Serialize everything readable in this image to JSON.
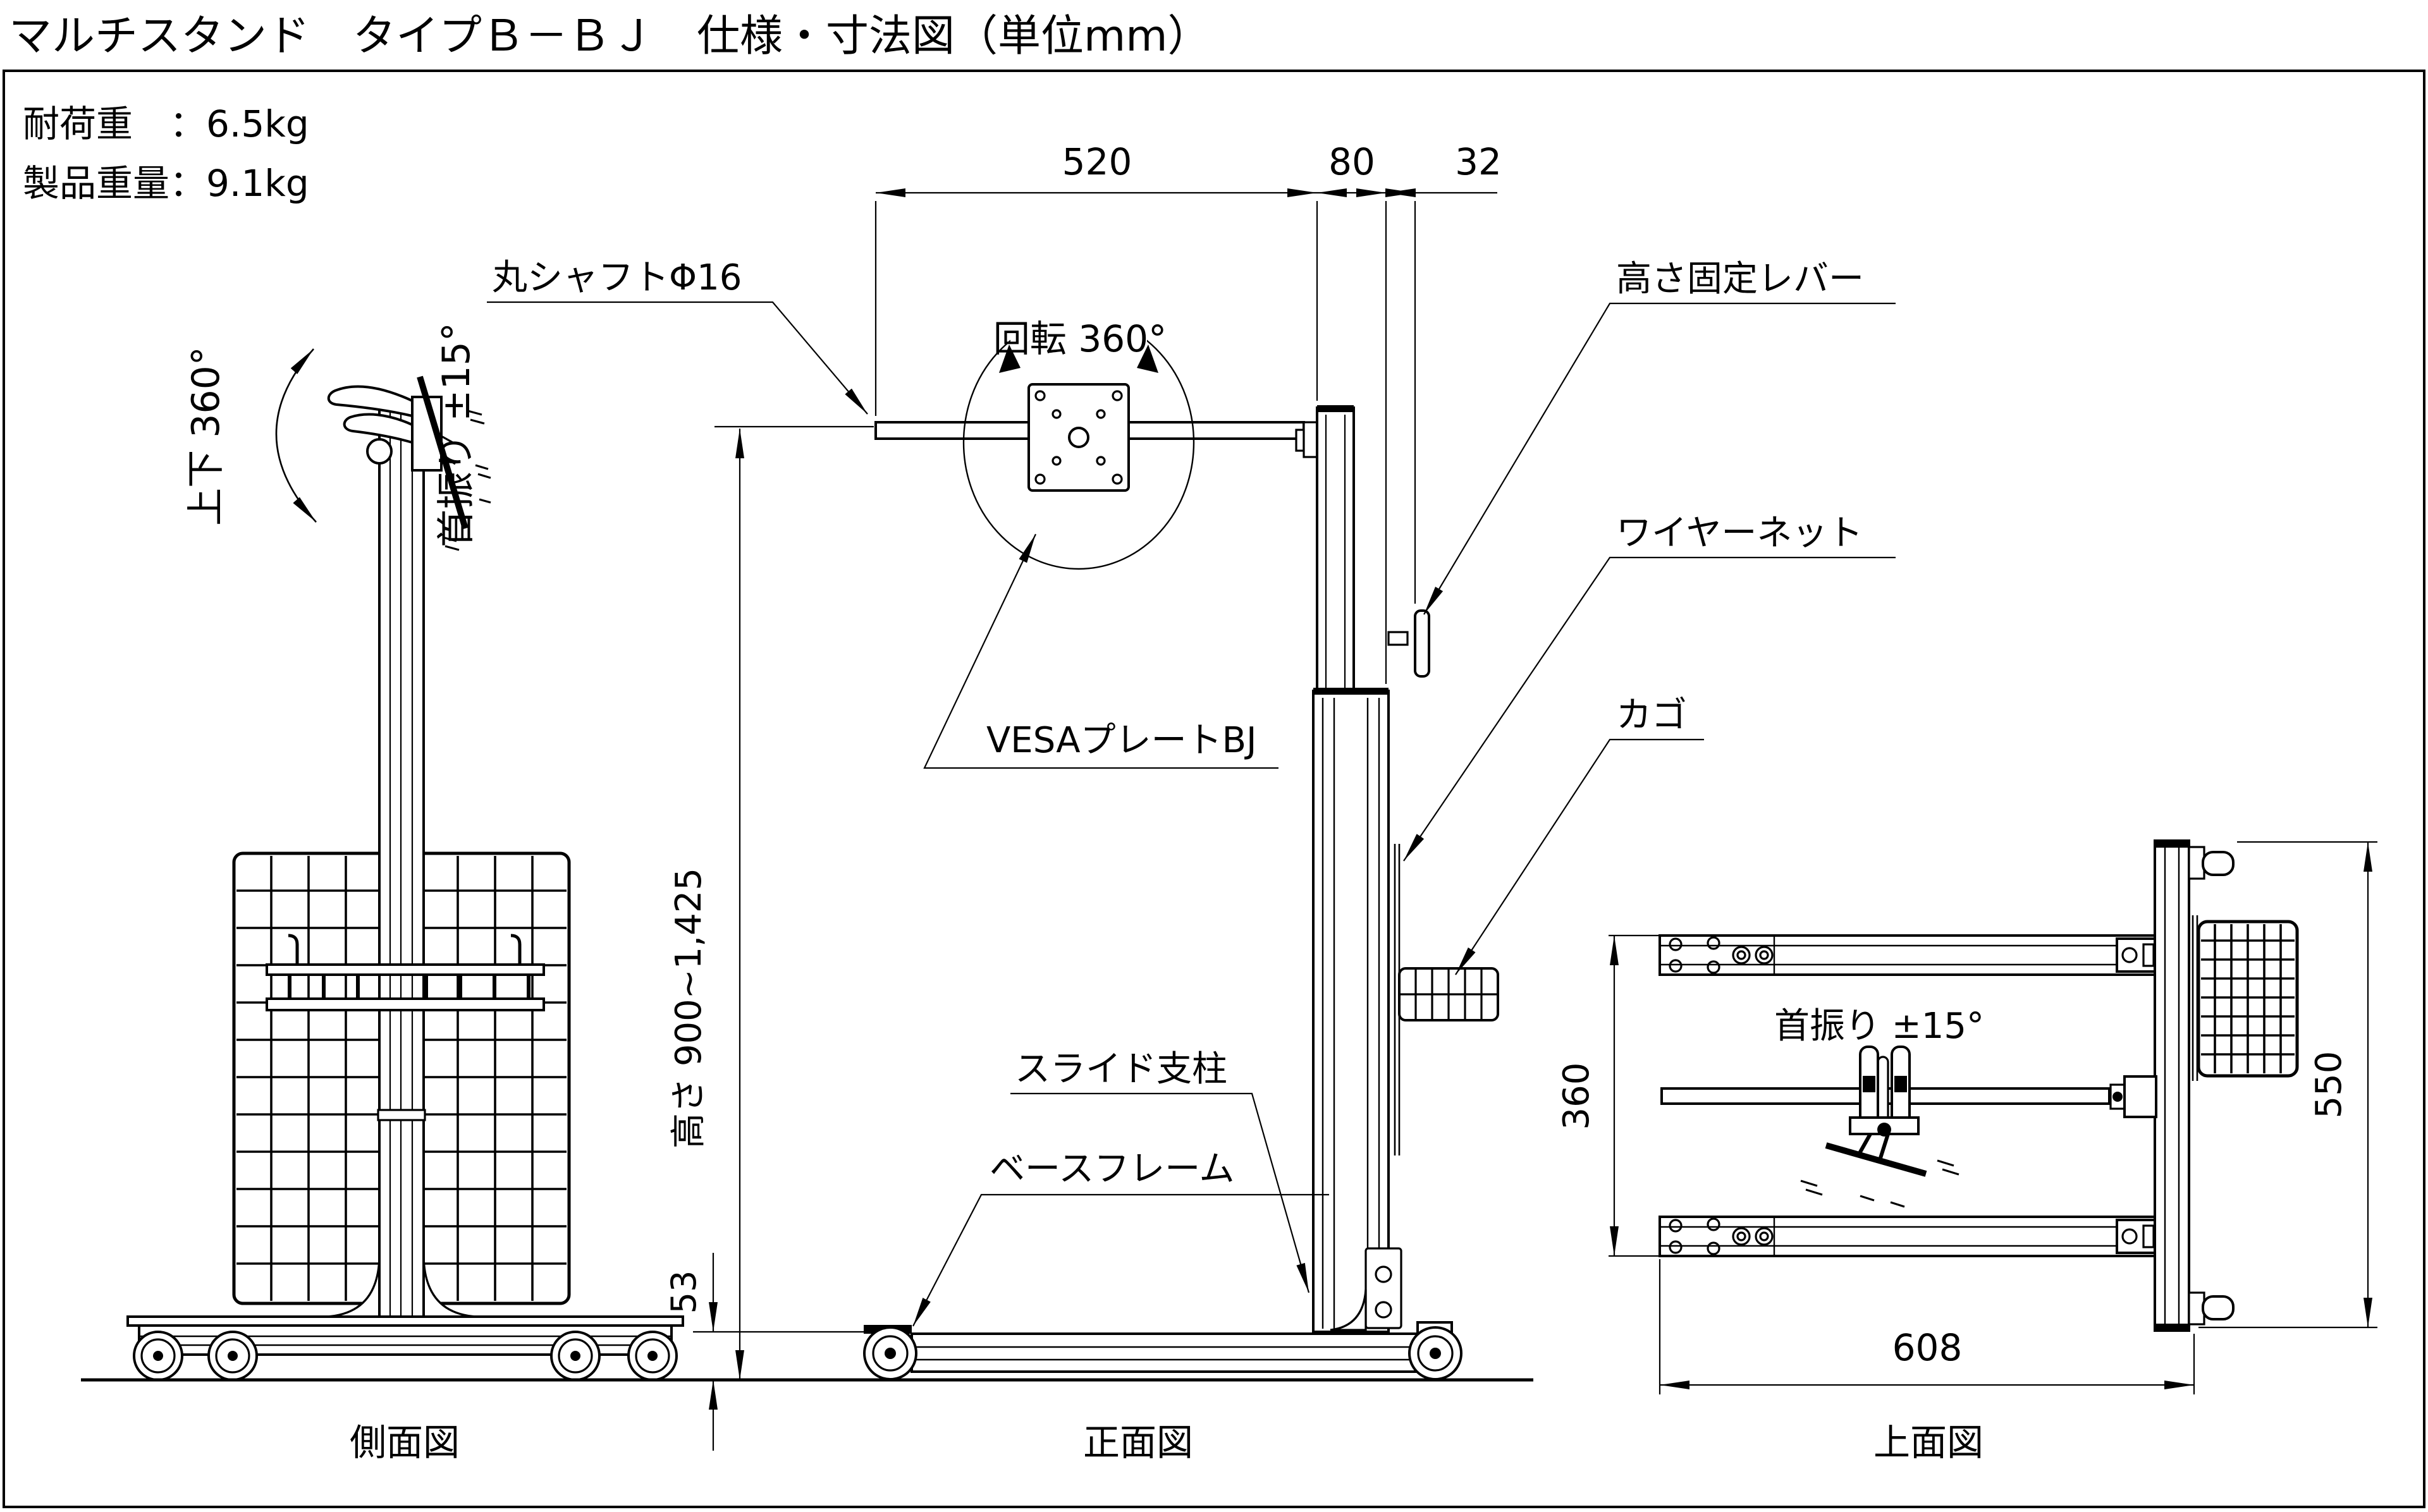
{
  "page": {
    "title": "マルチスタンド　タイプＢ－ＢＪ　仕様・寸法図（単位mm）"
  },
  "specs": {
    "load_capacity": "耐荷重　：6.5kg",
    "product_weight": "製品重量：9.1kg"
  },
  "side_view": {
    "caption": "側面図",
    "annotations": {
      "tilt": "上下 360°",
      "swivel": "首振り ±15°"
    }
  },
  "front_view": {
    "caption": "正面図",
    "dimensions": {
      "arm_length": "520",
      "column_width": "80",
      "net_offset": "32",
      "height_range": "高さ 900~1,425",
      "base_height": "53"
    },
    "labels": {
      "shaft": "丸シャフトΦ16",
      "rotation": "回転 360°",
      "vesa_plate": "VESAプレートBJ",
      "height_lever": "高さ固定レバー",
      "wire_net": "ワイヤーネット",
      "basket": "カゴ",
      "slide_column": "スライド支柱",
      "base_frame": "ベースフレーム"
    }
  },
  "top_view": {
    "caption": "上面図",
    "annotations": {
      "swivel": "首振り ±15°"
    },
    "dimensions": {
      "frame_depth": "360",
      "total_depth": "550",
      "total_width": "608"
    }
  },
  "colors": {
    "ink": "#000000",
    "paper": "#ffffff"
  }
}
